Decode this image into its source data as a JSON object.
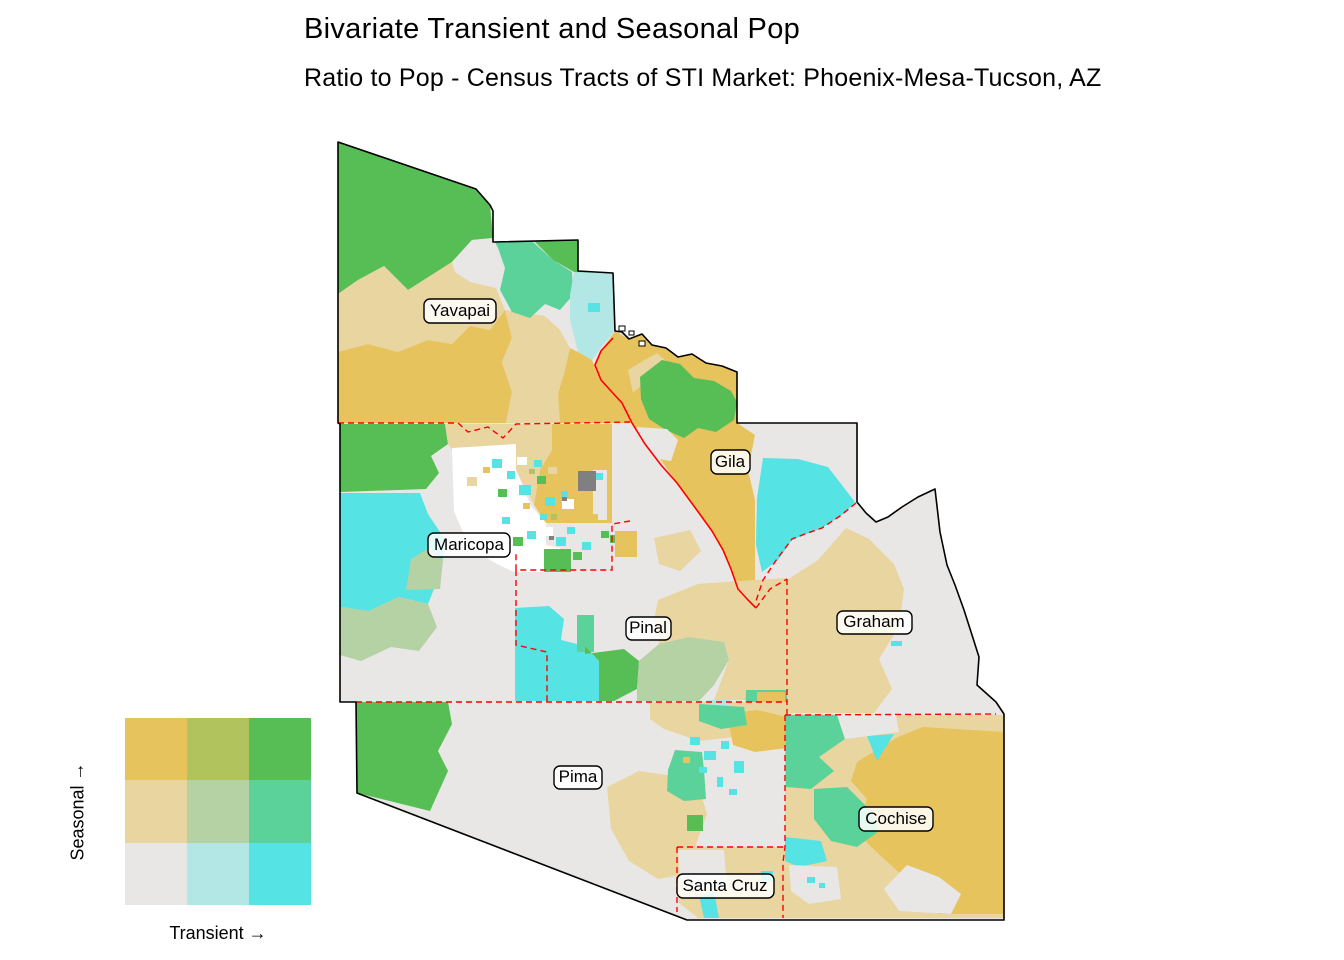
{
  "title": "Bivariate Transient and Seasonal Pop",
  "subtitle": "Ratio to Pop - Census Tracts of STI Market: Phoenix-Mesa-Tucson, AZ",
  "legend": {
    "y_label": "Seasonal →",
    "x_label": "Transient →",
    "cell_colors": [
      "#E7C35E",
      "#B0C35D",
      "#56BE55",
      "#E9D5A0",
      "#B5D2A4",
      "#5BD29A",
      "#E8E7E6",
      "#B2E7E5",
      "#55E3E3"
    ]
  },
  "map": {
    "counties": [
      {
        "name": "Yavapai"
      },
      {
        "name": "Gila"
      },
      {
        "name": "Maricopa"
      },
      {
        "name": "Pinal"
      },
      {
        "name": "Graham"
      },
      {
        "name": "Pima"
      },
      {
        "name": "Cochise"
      },
      {
        "name": "Santa Cruz"
      }
    ],
    "county_border_color": "#FF0000",
    "outline_color": "#000000",
    "missing_color": "#808080"
  }
}
